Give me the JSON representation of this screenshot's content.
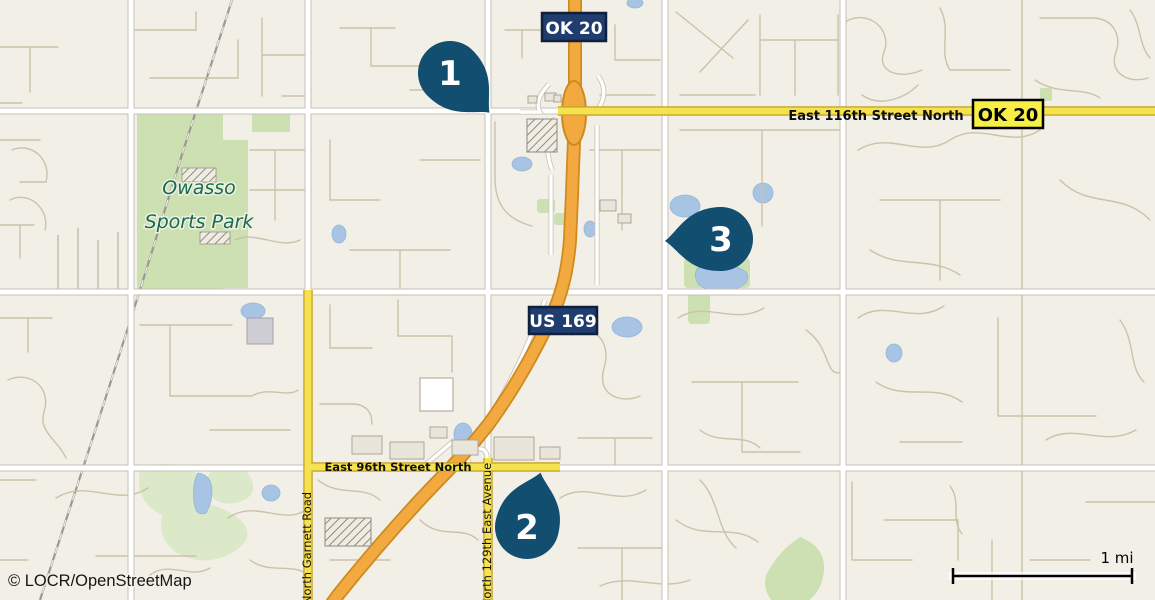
{
  "map": {
    "attribution": "© LOCR/OpenStreetMap",
    "scale_label": "1 mi",
    "park_label": {
      "line1": "Owasso",
      "line2": "Sports Park"
    },
    "roads": {
      "e116th": "East 116th Street North",
      "e96th": "East 96th Street North",
      "garnett": "North Garnett Road",
      "ave129th": "North 129th East Avenue"
    },
    "shields": {
      "ok20_top": "OK 20",
      "ok20_right": "OK 20",
      "us169": "US 169"
    },
    "markers": [
      {
        "label": "1"
      },
      {
        "label": "2"
      },
      {
        "label": "3"
      }
    ],
    "colors": {
      "background": "#f2efe7",
      "marker": "#124e6f",
      "shield_navy": "#1f3d6e",
      "shield_yellow": "#f7ef45",
      "road_yellow": "#f4e24e",
      "highway_orange": "#f2a93f",
      "park_green": "#cde0b2",
      "water_blue": "#a8c4e4",
      "park_label_green": "#186b4d"
    }
  }
}
